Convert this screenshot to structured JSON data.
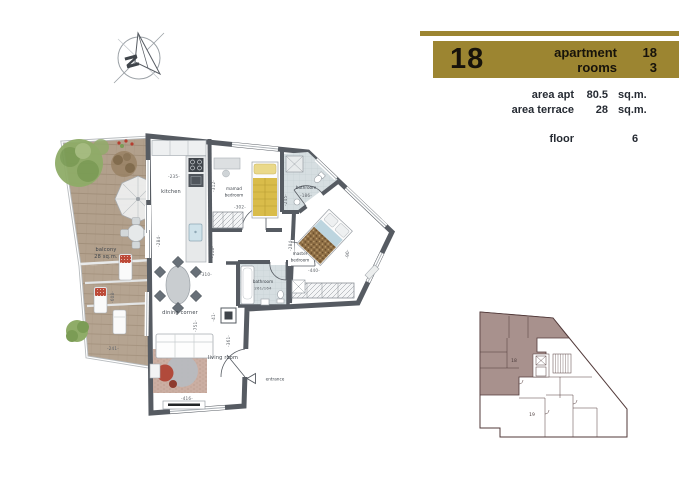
{
  "title_block": {
    "bar_color": "#9c8531",
    "text_color": "#17130b",
    "apartment_number": "18",
    "info_rows": [
      {
        "label": "apartment",
        "value": "18"
      },
      {
        "label": "rooms",
        "value": "3"
      }
    ],
    "area_rows": [
      {
        "label": "area apt",
        "value": "80.5",
        "unit": "sq.m."
      },
      {
        "label": "area terrace",
        "value": "28",
        "unit": "sq.m."
      }
    ],
    "floor_row": {
      "label": "floor",
      "value": "6"
    }
  },
  "compass": {
    "letter": "N"
  },
  "floor_plan": {
    "rooms": {
      "kitchen": "kitchen",
      "mamad": [
        "mamad",
        "bedroom"
      ],
      "bathroom_top": "bathroom",
      "master": [
        "master",
        "bedroom"
      ],
      "bathroom_center": [
        "bathroom",
        "261/164"
      ],
      "dining": "dining corner",
      "living": "living room",
      "balcony": [
        "balcony",
        "28 sq.m."
      ],
      "entrance": "entrance"
    },
    "dimensions": {
      "kitchen_w": "-235-",
      "kitchen_h": "-284-",
      "mamad_w": "-302-",
      "mamad_h": "-312-",
      "bath_top_w": "-186-",
      "bath_top_h": "-245-",
      "master_w": "-440-",
      "master_h": "-284-",
      "master_side": "-90-",
      "corridor_h": "-118-",
      "dining_w": "-310-",
      "living_len": "-751-",
      "living_w": "-361-",
      "shaft": "-41-",
      "tv_wall": "-416-",
      "balcony_len": "-608-",
      "balcony_w": "-241-"
    },
    "colors": {
      "wall": "#565b62",
      "wood": "#b2a08c",
      "tile": "#d6dee1",
      "accent_red": "#b14a3b",
      "tree_green": "#8fac68"
    }
  },
  "key_plan": {
    "highlight_color": "#a8918d",
    "line_color": "#523a3a",
    "units": [
      {
        "id": "18"
      },
      {
        "id": "19"
      }
    ]
  }
}
